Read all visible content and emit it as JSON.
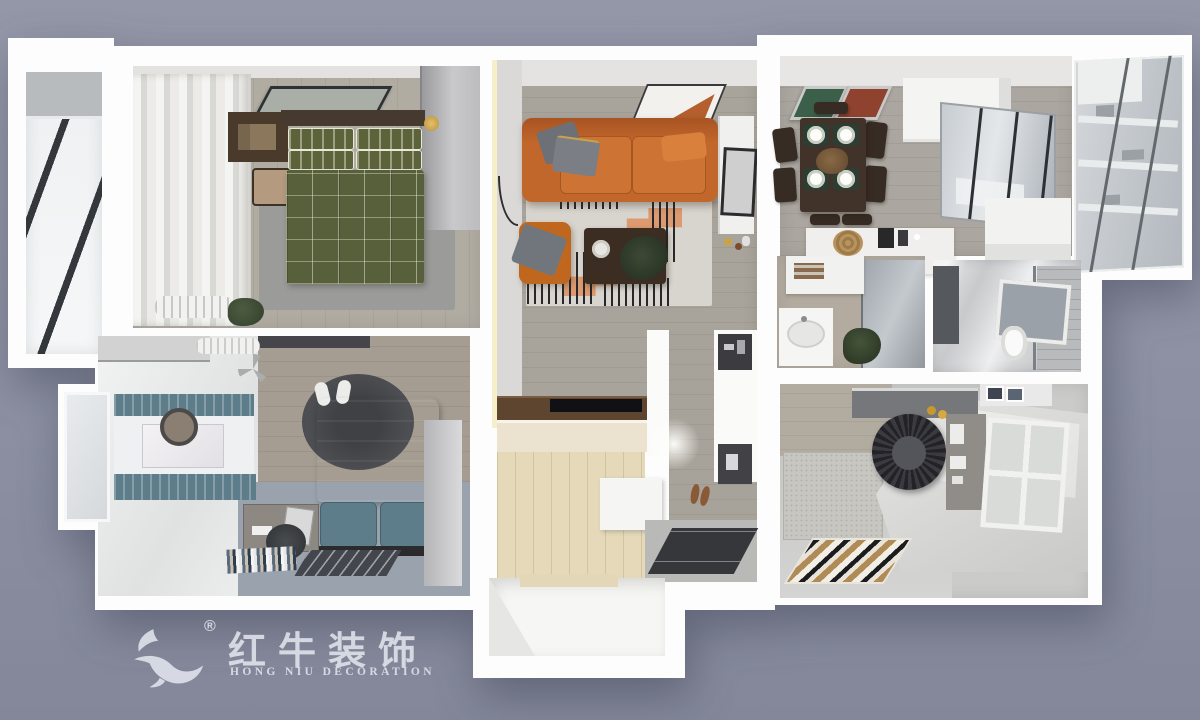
{
  "scene": {
    "type": "3d-floorplan-top-down-render",
    "background_color": "#8c90a2",
    "wall_color": "#fdfdfd"
  },
  "watermark": {
    "brand_cn": "红牛装饰",
    "brand_en": "HONG NIU DECORATION",
    "registered_mark": "®",
    "color": "#e8ebf3"
  },
  "rooms": [
    {
      "id": "balcony-left",
      "floor": "#f2f3f4",
      "glazing_stripe": "#34383c"
    },
    {
      "id": "bedroom-master",
      "floor": "#b1aca2",
      "bedding": "#57603a",
      "rug": "#9b9b99",
      "nightstand": "#4a3a2c",
      "wardrobe": "#c9c9cb",
      "curtains": "#ecebe7"
    },
    {
      "id": "bedroom-second",
      "floor": "#9aa3ad",
      "bedding": "#4d6670",
      "round_rug": "#4d4f52",
      "curtains": "#5d7d8a",
      "desk": "#8e8882"
    },
    {
      "id": "living-room",
      "floor": "#a9a49b",
      "sofa": "#c2672c",
      "armchair": "#bf671f",
      "rug": "#d8d5ce",
      "rug_accent": "#dc9365",
      "coffee_table": "#3b2d22",
      "led_strip": "#f6efc9"
    },
    {
      "id": "tv-media-wall",
      "counter": "#5d452f",
      "tv": "#101114",
      "cabinet": "#ebe3cf"
    },
    {
      "id": "entry-hall",
      "floor": "#e5d9ba",
      "corridor_floor": "#a8a39a",
      "door_mat": "#35373b"
    },
    {
      "id": "dining-kitchen",
      "floor": "#aba69f",
      "table": "#42332a",
      "placemat": "#2c3e33",
      "art_left": "#3b5f49",
      "art_right": "#8f432f",
      "glass_partition": "#c7ccd1"
    },
    {
      "id": "balcony-right",
      "glass": "#bfc4c9",
      "shelves": "#e9ecec"
    },
    {
      "id": "washroom",
      "vanity": "#f5f5f3",
      "glass": "#9fa5ab",
      "plant": "#44543a"
    },
    {
      "id": "bathroom",
      "marble": "#d6d7d9",
      "partition": "#55585c",
      "window": "#9ba1a9"
    },
    {
      "id": "tatami-room",
      "platform": "#e6e6e4",
      "rattan_chair": "#3a3a40",
      "rug_stripes": [
        "#1c1c1e",
        "#e8e4da",
        "#b08b55",
        "#f2efe6"
      ],
      "window_frame": "#f1f1ef"
    }
  ]
}
